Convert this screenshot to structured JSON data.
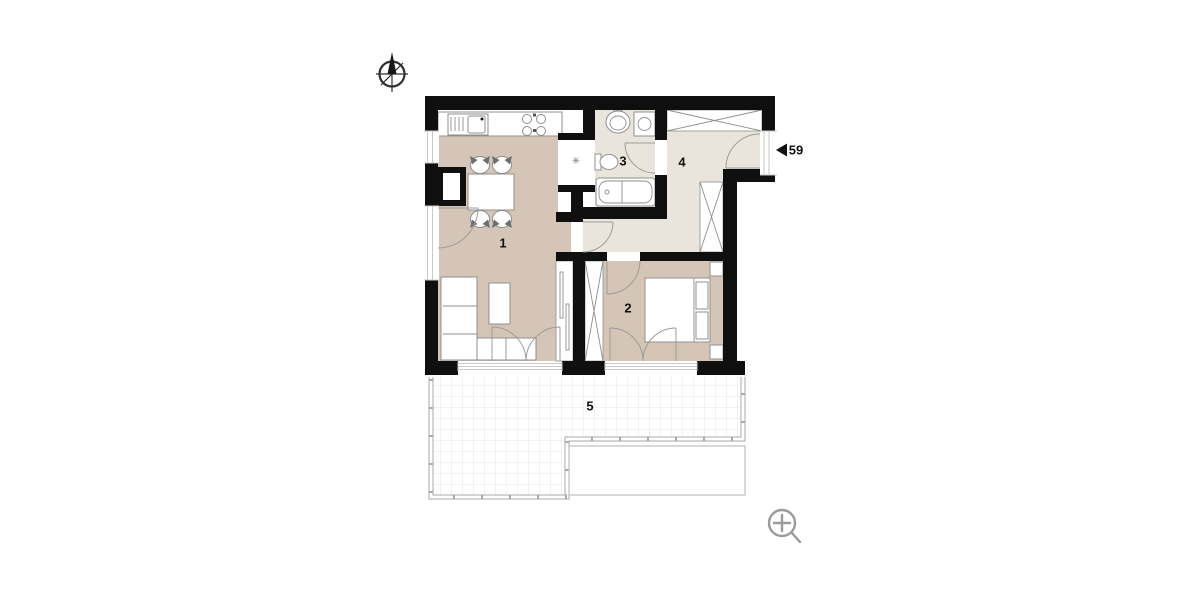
{
  "plan": {
    "rooms": [
      {
        "id": "living-room-kitchen",
        "label": "1"
      },
      {
        "id": "bedroom",
        "label": "2"
      },
      {
        "id": "bathroom",
        "label": "3"
      },
      {
        "id": "hallway",
        "label": "4"
      },
      {
        "id": "terrace",
        "label": "5"
      }
    ],
    "entrance": {
      "unit_label": "59"
    },
    "shaft_symbol": "✳"
  },
  "icons": {
    "compass": "north-compass-icon",
    "zoom": "zoom-in-icon",
    "entrance_arrow": "left-arrow-icon"
  },
  "colors": {
    "background": "#ffffff",
    "wall": "#0f0f0f",
    "floor_living": "#d5c5b7",
    "floor_service": "#eae5dc",
    "furniture_stroke": "#8f8f8f",
    "railing": "#a9a9a9",
    "grid": "#e6e6e6",
    "sill": "#c9c9c9",
    "icon_gray": "#9a9a9a",
    "outline_light": "#bdbdbd"
  }
}
